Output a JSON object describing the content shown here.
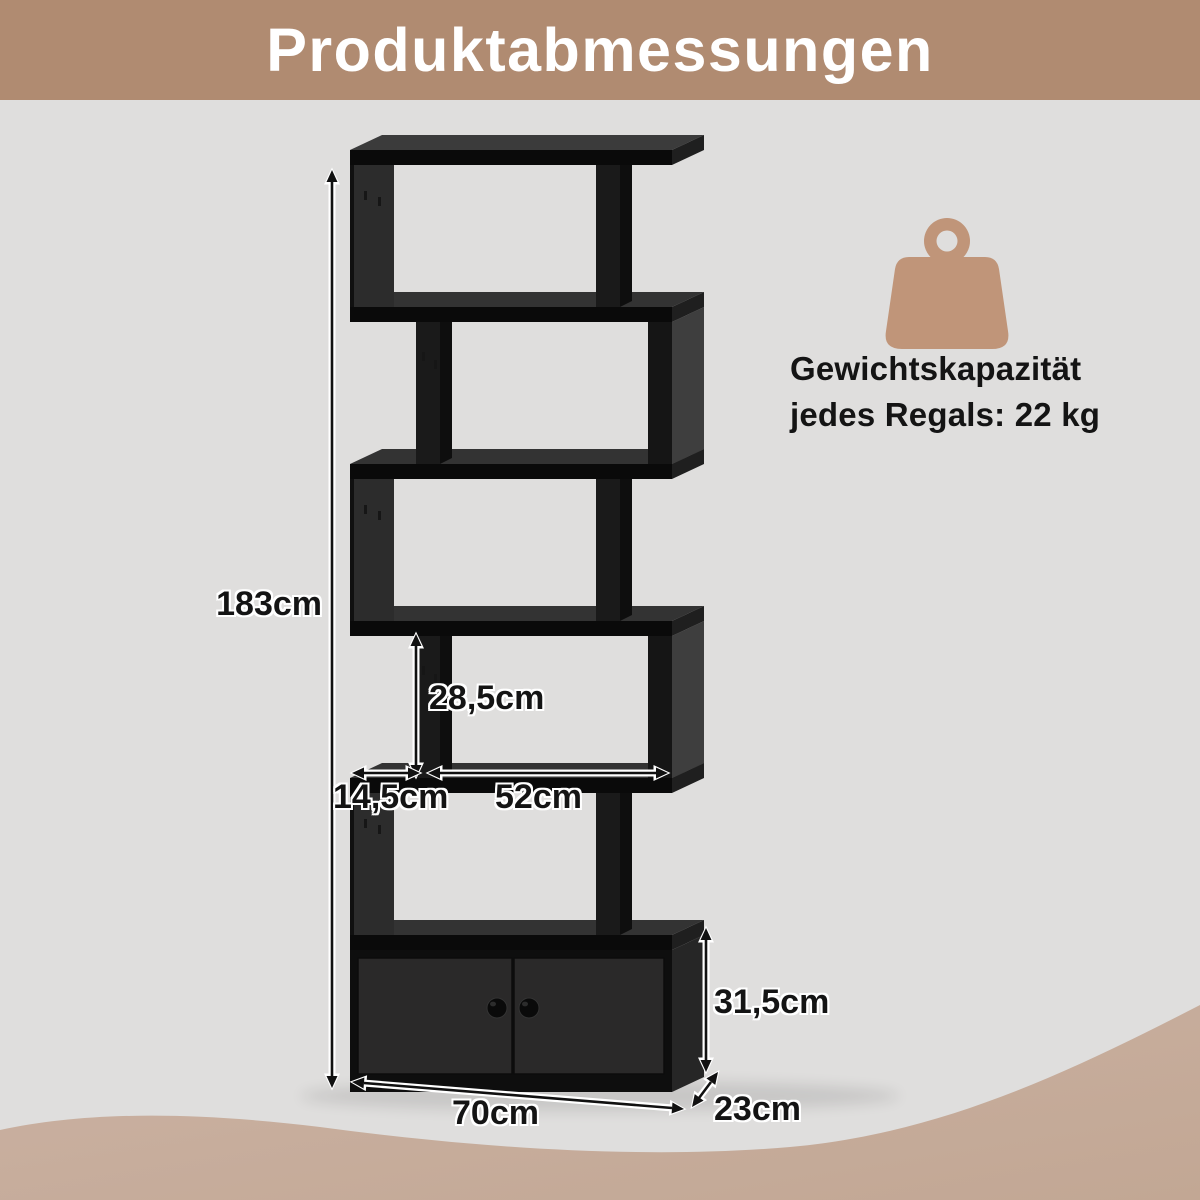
{
  "header": {
    "title": "Produktabmessungen"
  },
  "dimensions": {
    "total_height": "183cm",
    "shelf_inner_height": "28,5cm",
    "side_offset": "14,5cm",
    "opening_width": "52cm",
    "cabinet_height": "31,5cm",
    "total_width": "70cm",
    "depth": "23cm"
  },
  "weight_capacity": {
    "line1": "Gewichtskapazität",
    "line2": "jedes Regals: 22 kg"
  },
  "icons": {
    "weight": "weight-icon"
  },
  "colors": {
    "header_bg": "#b08b71",
    "page_bg": "#dfdedd",
    "wave_top": "#cbb2a3",
    "wave_bottom": "#c2a794",
    "icon_brown": "#c09579",
    "title_text": "#ffffff",
    "label_text": "#141414",
    "shelf_front": "#0a0a0a",
    "shelf_top": "#333333",
    "shelf_end": "#1f1f1f",
    "panel_face": "#2c2c2c",
    "divider_face": "#1a1a1a",
    "divider_side": "#0e0e0e",
    "right_panel_front": "#151515",
    "right_panel_side": "#3e3e3e",
    "cabinet_front": "#0e0e0e",
    "cabinet_side": "#262626",
    "door_face": "#2a2929",
    "arrow_ink": "#111111",
    "arrow_halo": "#ffffff"
  }
}
